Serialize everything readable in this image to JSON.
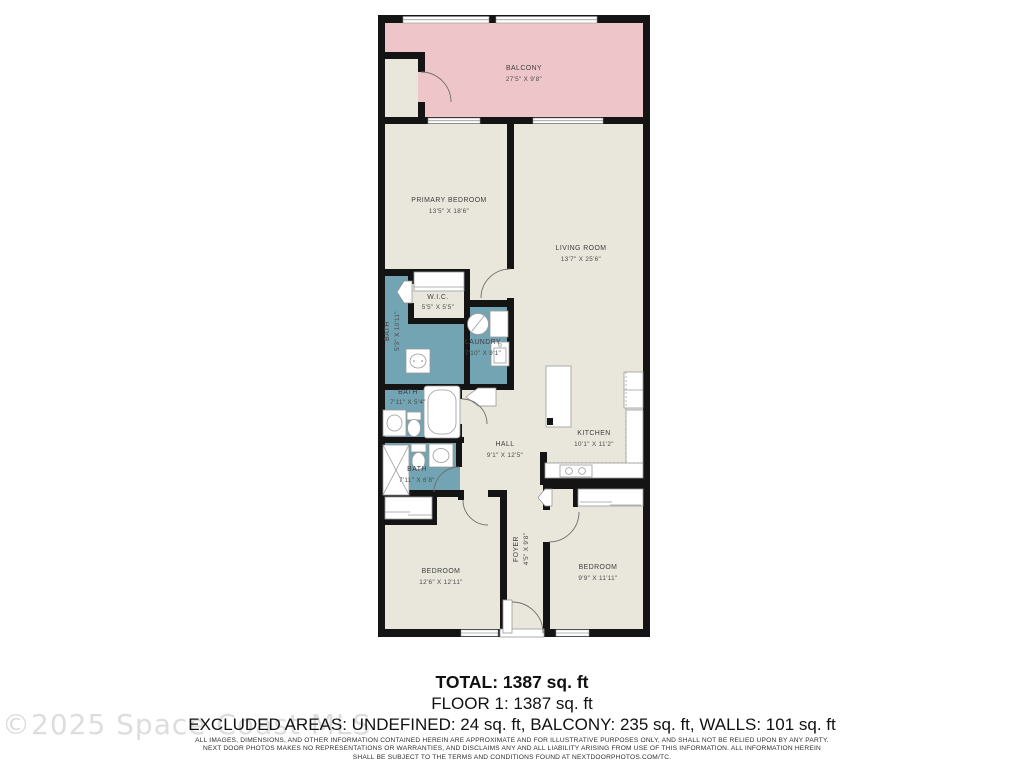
{
  "watermark": "©2025 Space Coast MLS",
  "summary": {
    "total": "TOTAL: 1387 sq. ft",
    "floor1": "FLOOR 1: 1387 sq. ft",
    "excluded": "EXCLUDED AREAS: UNDEFINED: 24 sq. ft, BALCONY: 235 sq. ft, WALLS: 101 sq. ft"
  },
  "disclaimer": {
    "line1": "ALL IMAGES, DIMENSIONS, AND OTHER INFORMATION CONTAINED HEREIN ARE APPROXIMATE AND FOR ILLUSTRATIVE PURPOSES ONLY, AND SHALL NOT BE RELIED UPON BY ANY PARTY.",
    "line2": "NEXT DOOR PHOTOS MAKES NO REPRESENTATIONS OR WARRANTIES, AND DISCLAIMS ANY AND ALL LIABILITY ARISING FROM USE OF THIS INFORMATION. ALL INFORMATION HEREIN",
    "line3": "SHALL BE SUBJECT TO THE TERMS AND CONDITIONS FOUND AT NEXTDOORPHOTOS.COM/TC."
  },
  "rooms": {
    "balcony": {
      "name": "BALCONY",
      "dims": "27'5\" X 9'8\""
    },
    "primary_bedroom": {
      "name": "PRIMARY BEDROOM",
      "dims": "13'5\" X 18'6\""
    },
    "living_room": {
      "name": "LIVING ROOM",
      "dims": "13'7\" X 25'6\""
    },
    "wic": {
      "name": "W.I.C.",
      "dims": "5'5\" X 5'5\""
    },
    "bath1": {
      "name": "BATH",
      "dims": "5'3\" X 10'11\""
    },
    "laundry": {
      "name": "LAUNDRY",
      "dims": "7'10\" X 9'1\""
    },
    "bath2": {
      "name": "BATH",
      "dims": "7'11\" X 5'4\""
    },
    "bath3": {
      "name": "BATH",
      "dims": "7'11\" X 6'8\""
    },
    "hall": {
      "name": "HALL",
      "dims": "9'1\" X 12'5\""
    },
    "kitchen": {
      "name": "KITCHEN",
      "dims": "10'1\" X 11'2\""
    },
    "foyer": {
      "name": "FOYER",
      "dims": "4'5\" X 9'8\""
    },
    "bedroom_left": {
      "name": "BEDROOM",
      "dims": "12'6\" X 12'11\""
    },
    "bedroom_right": {
      "name": "BEDROOM",
      "dims": "9'9\" X 11'11\""
    }
  },
  "colors": {
    "room_fill": "#e9e7dc",
    "balcony_fill": "#eec6ca",
    "wet_room_fill": "#72a4b3",
    "wall": "#141414"
  }
}
